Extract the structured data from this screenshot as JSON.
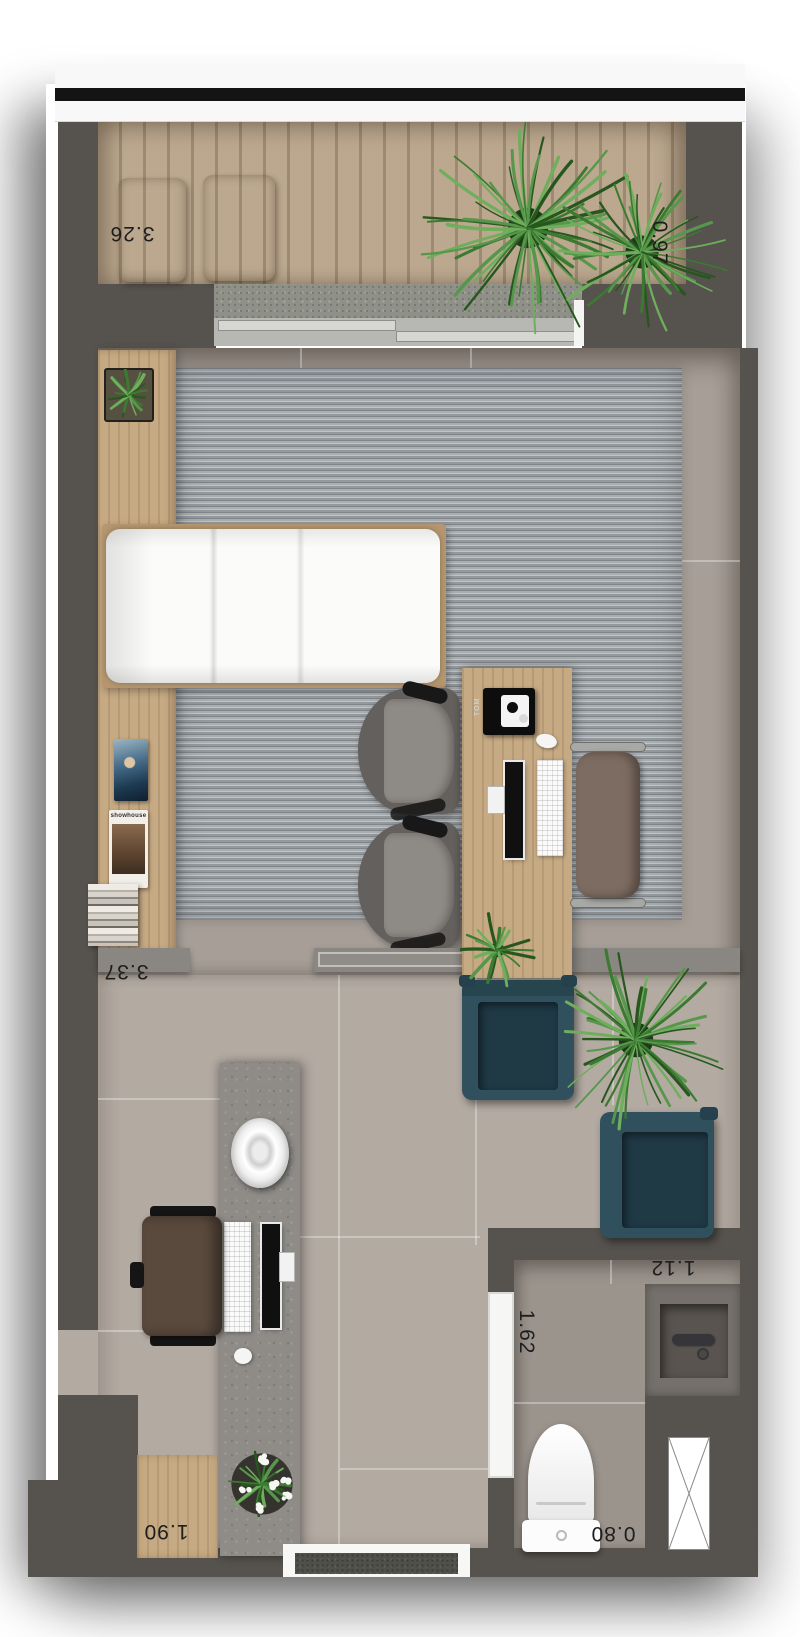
{
  "plan": {
    "dimension_labels": {
      "balcony_width": "3.26",
      "balcony_depth": "0.97",
      "room_width": "3.37",
      "hall_width": "1.62",
      "bathroom_width": "1.12",
      "bathroom_depth": "0.80",
      "entry_width": "1.90"
    },
    "object_texts": {
      "desk_camera": "TOM",
      "magazine_cover": "showhouse"
    },
    "colors": {
      "wall": "#56524e",
      "deck_wood": "#bca88f",
      "furniture_wood": "#c6aa84",
      "rug": "#a9aeb2",
      "tile_upper": "#a69e97",
      "tile_lower": "#b3aaa2",
      "counter_concrete": "#8f8c88",
      "armchair_teal": "#30505d",
      "plant_green": "#44813a",
      "railing_stripe": "#141414"
    }
  }
}
